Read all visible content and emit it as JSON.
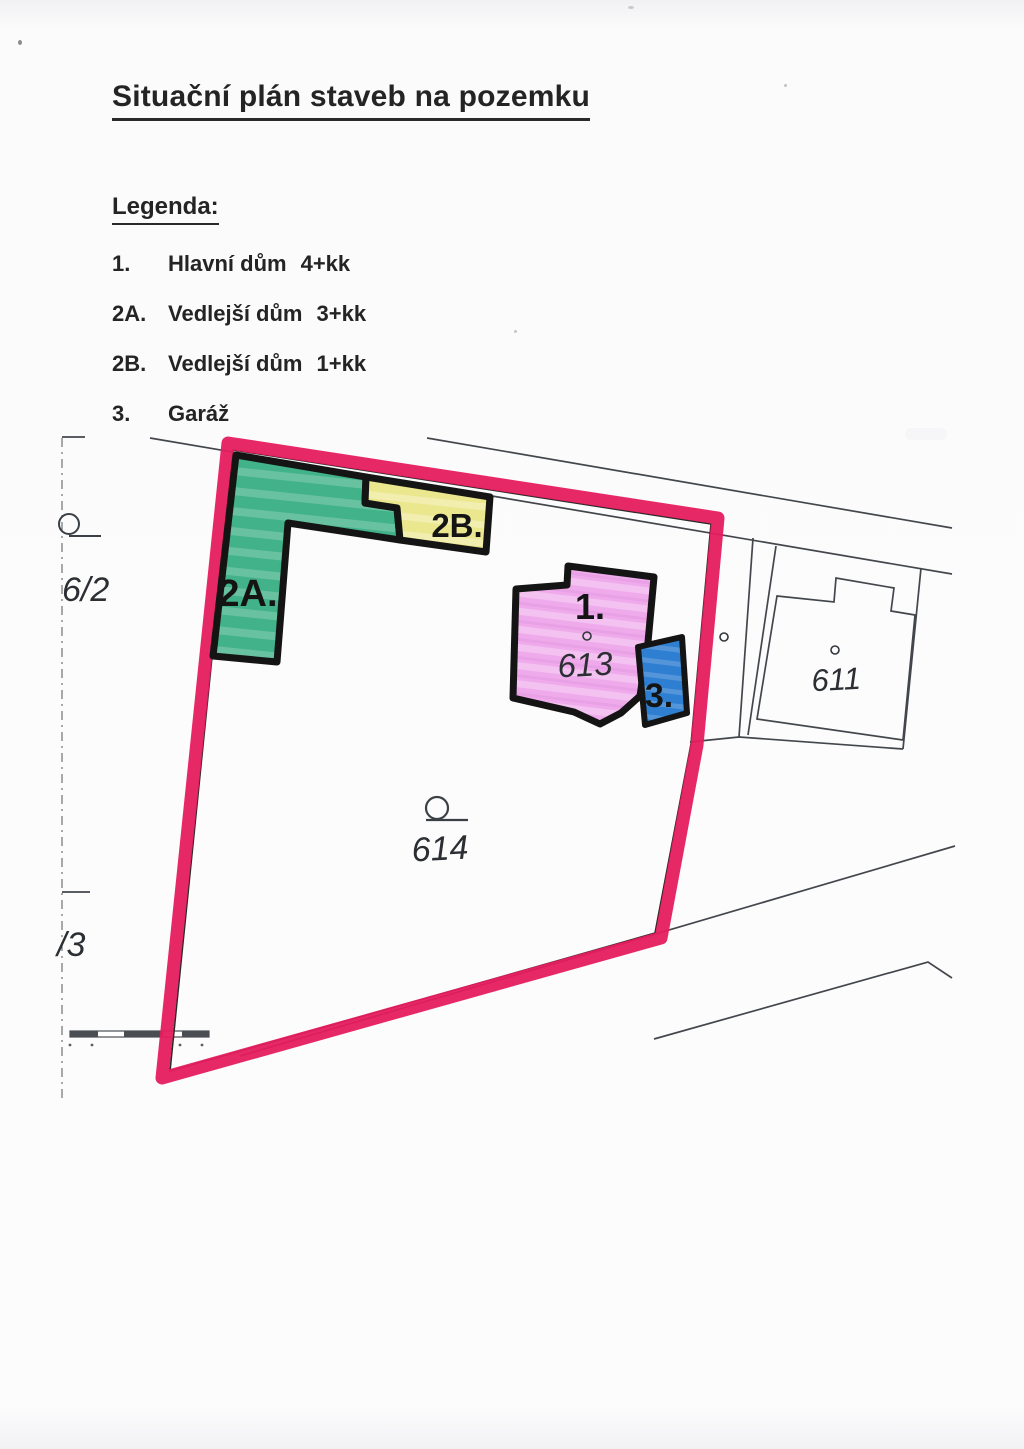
{
  "page": {
    "title": "Situační plán staveb na pozemku"
  },
  "legend": {
    "heading": "Legenda:",
    "items": [
      {
        "key": "1.",
        "name": "Hlavní dům",
        "unit": "4+kk"
      },
      {
        "key": "2A.",
        "name": "Vedlejší dům",
        "unit": "3+kk"
      },
      {
        "key": "2B.",
        "name": "Vedlejší dům",
        "unit": "1+kk"
      },
      {
        "key": "3.",
        "name": "Garáž",
        "unit": ""
      }
    ]
  },
  "map": {
    "labels": {
      "main_house": "1.",
      "side_house_a": "2A.",
      "side_house_b": "2B.",
      "garage": "3.",
      "parcel_main_house": "613",
      "parcel_neighbor": "611",
      "parcel_garden": "614",
      "parcel_left_upper": "6/2",
      "parcel_left_lower": "/3"
    },
    "colors": {
      "boundary": "#e61c5f",
      "side_house_a_fill": "#42b28a",
      "side_house_b_fill": "#ebe78e",
      "main_house_fill": "#efaaec",
      "garage_fill": "#2e7ed2"
    }
  }
}
